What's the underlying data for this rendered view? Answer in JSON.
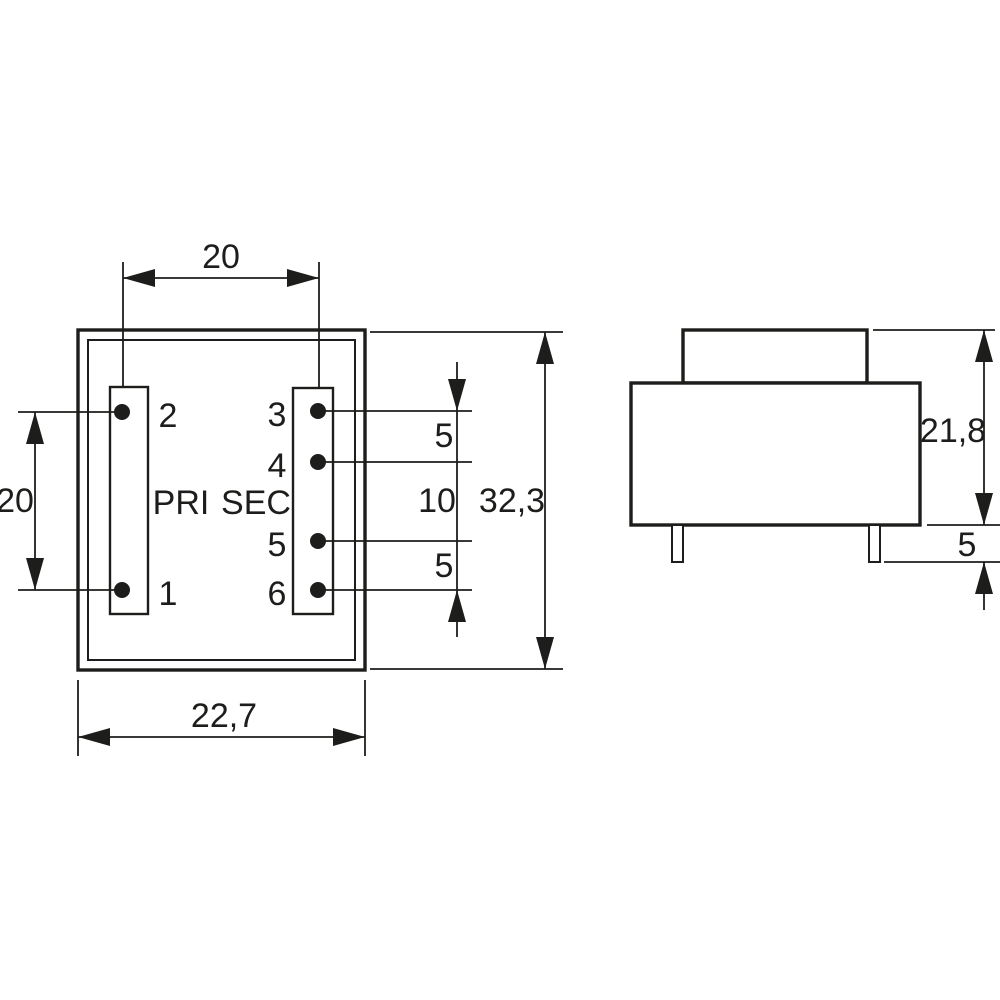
{
  "drawing": {
    "kind": "pcb-transformer-dimensional-drawing",
    "line_color": "#1d1d1b",
    "background": "#ffffff",
    "top_view": {
      "winding_labels": {
        "primary": "PRI",
        "secondary": "SEC"
      },
      "pins": {
        "p1": "1",
        "p2": "2",
        "p3": "3",
        "p4": "4",
        "p5": "5",
        "p6": "6"
      },
      "dimensions": {
        "pin_column_spacing": "20",
        "primary_pin_pitch": "20",
        "body_width": "22,7",
        "body_length": "32,3",
        "sec_pitch_top": "5",
        "sec_pitch_middle": "10",
        "sec_pitch_bottom": "5"
      }
    },
    "side_view": {
      "dimensions": {
        "body_height": "21,8",
        "pin_length": "5"
      }
    }
  }
}
